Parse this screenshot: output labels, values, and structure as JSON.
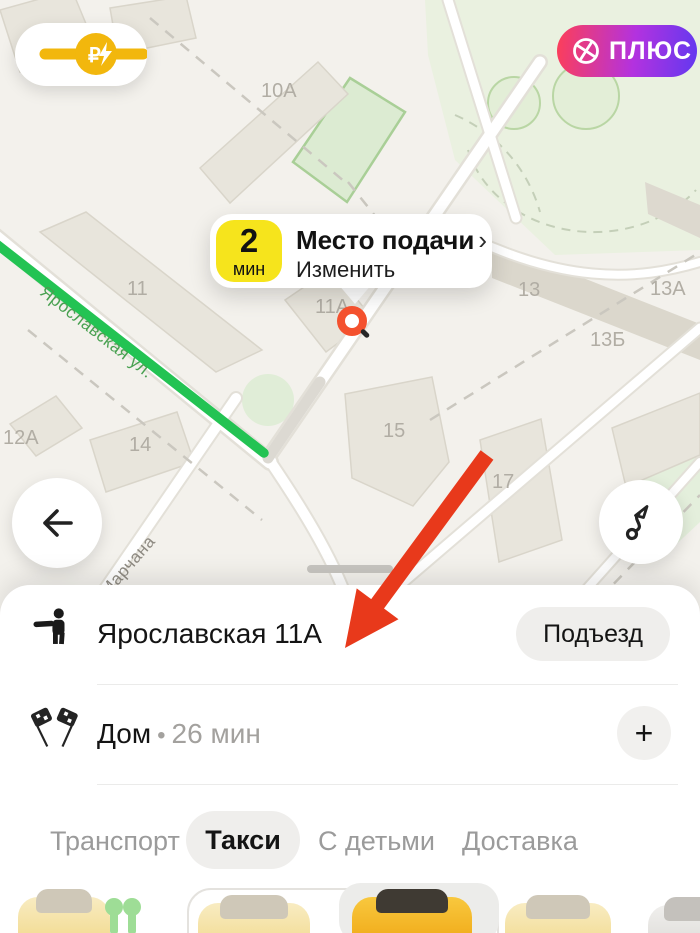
{
  "header": {
    "surge": {
      "currency": "₽"
    },
    "plus_badge": {
      "label": "ПЛЮС"
    }
  },
  "callout": {
    "eta_value": "2",
    "eta_unit": "мин",
    "title": "Место подачи",
    "chevron": "›",
    "subtitle": "Изменить"
  },
  "map": {
    "street_labels": [
      {
        "text": "Ярославская ул."
      },
      {
        "text": "Марчана"
      }
    ],
    "building_labels": [
      {
        "text": "10А"
      },
      {
        "text": "11"
      },
      {
        "text": "11А"
      },
      {
        "text": "12А"
      },
      {
        "text": "13"
      },
      {
        "text": "13А"
      },
      {
        "text": "13Б"
      },
      {
        "text": "14"
      },
      {
        "text": "15"
      },
      {
        "text": "17"
      }
    ]
  },
  "sheet": {
    "pickup": {
      "address": "Ярославская 11А",
      "entrance_label": "Подъезд"
    },
    "destination": {
      "name": "Дом",
      "separator": "•",
      "eta": "26 мин",
      "add_label": "+"
    },
    "tabs": [
      {
        "label": "Транспорт",
        "active": false
      },
      {
        "label": "Такси",
        "active": true
      },
      {
        "label": "С детьми",
        "active": false
      },
      {
        "label": "Доставка",
        "active": false
      }
    ],
    "vehicle_icons": [
      "taxi-pale-icon",
      "scooter-icon",
      "taxi-pale-icon",
      "taxi-selected-icon",
      "taxi-pale-icon",
      "car-white-icon"
    ]
  },
  "colors": {
    "route_green": "#23c353",
    "marker_red": "#f4512e",
    "arrow_red": "#e8391b",
    "eta_yellow": "#f6e41c",
    "surge_yellow": "#f2b70d",
    "plus_gradient_start": "#fa3e5d",
    "plus_gradient_end": "#6638ef",
    "pill_grey": "#efeeec"
  }
}
